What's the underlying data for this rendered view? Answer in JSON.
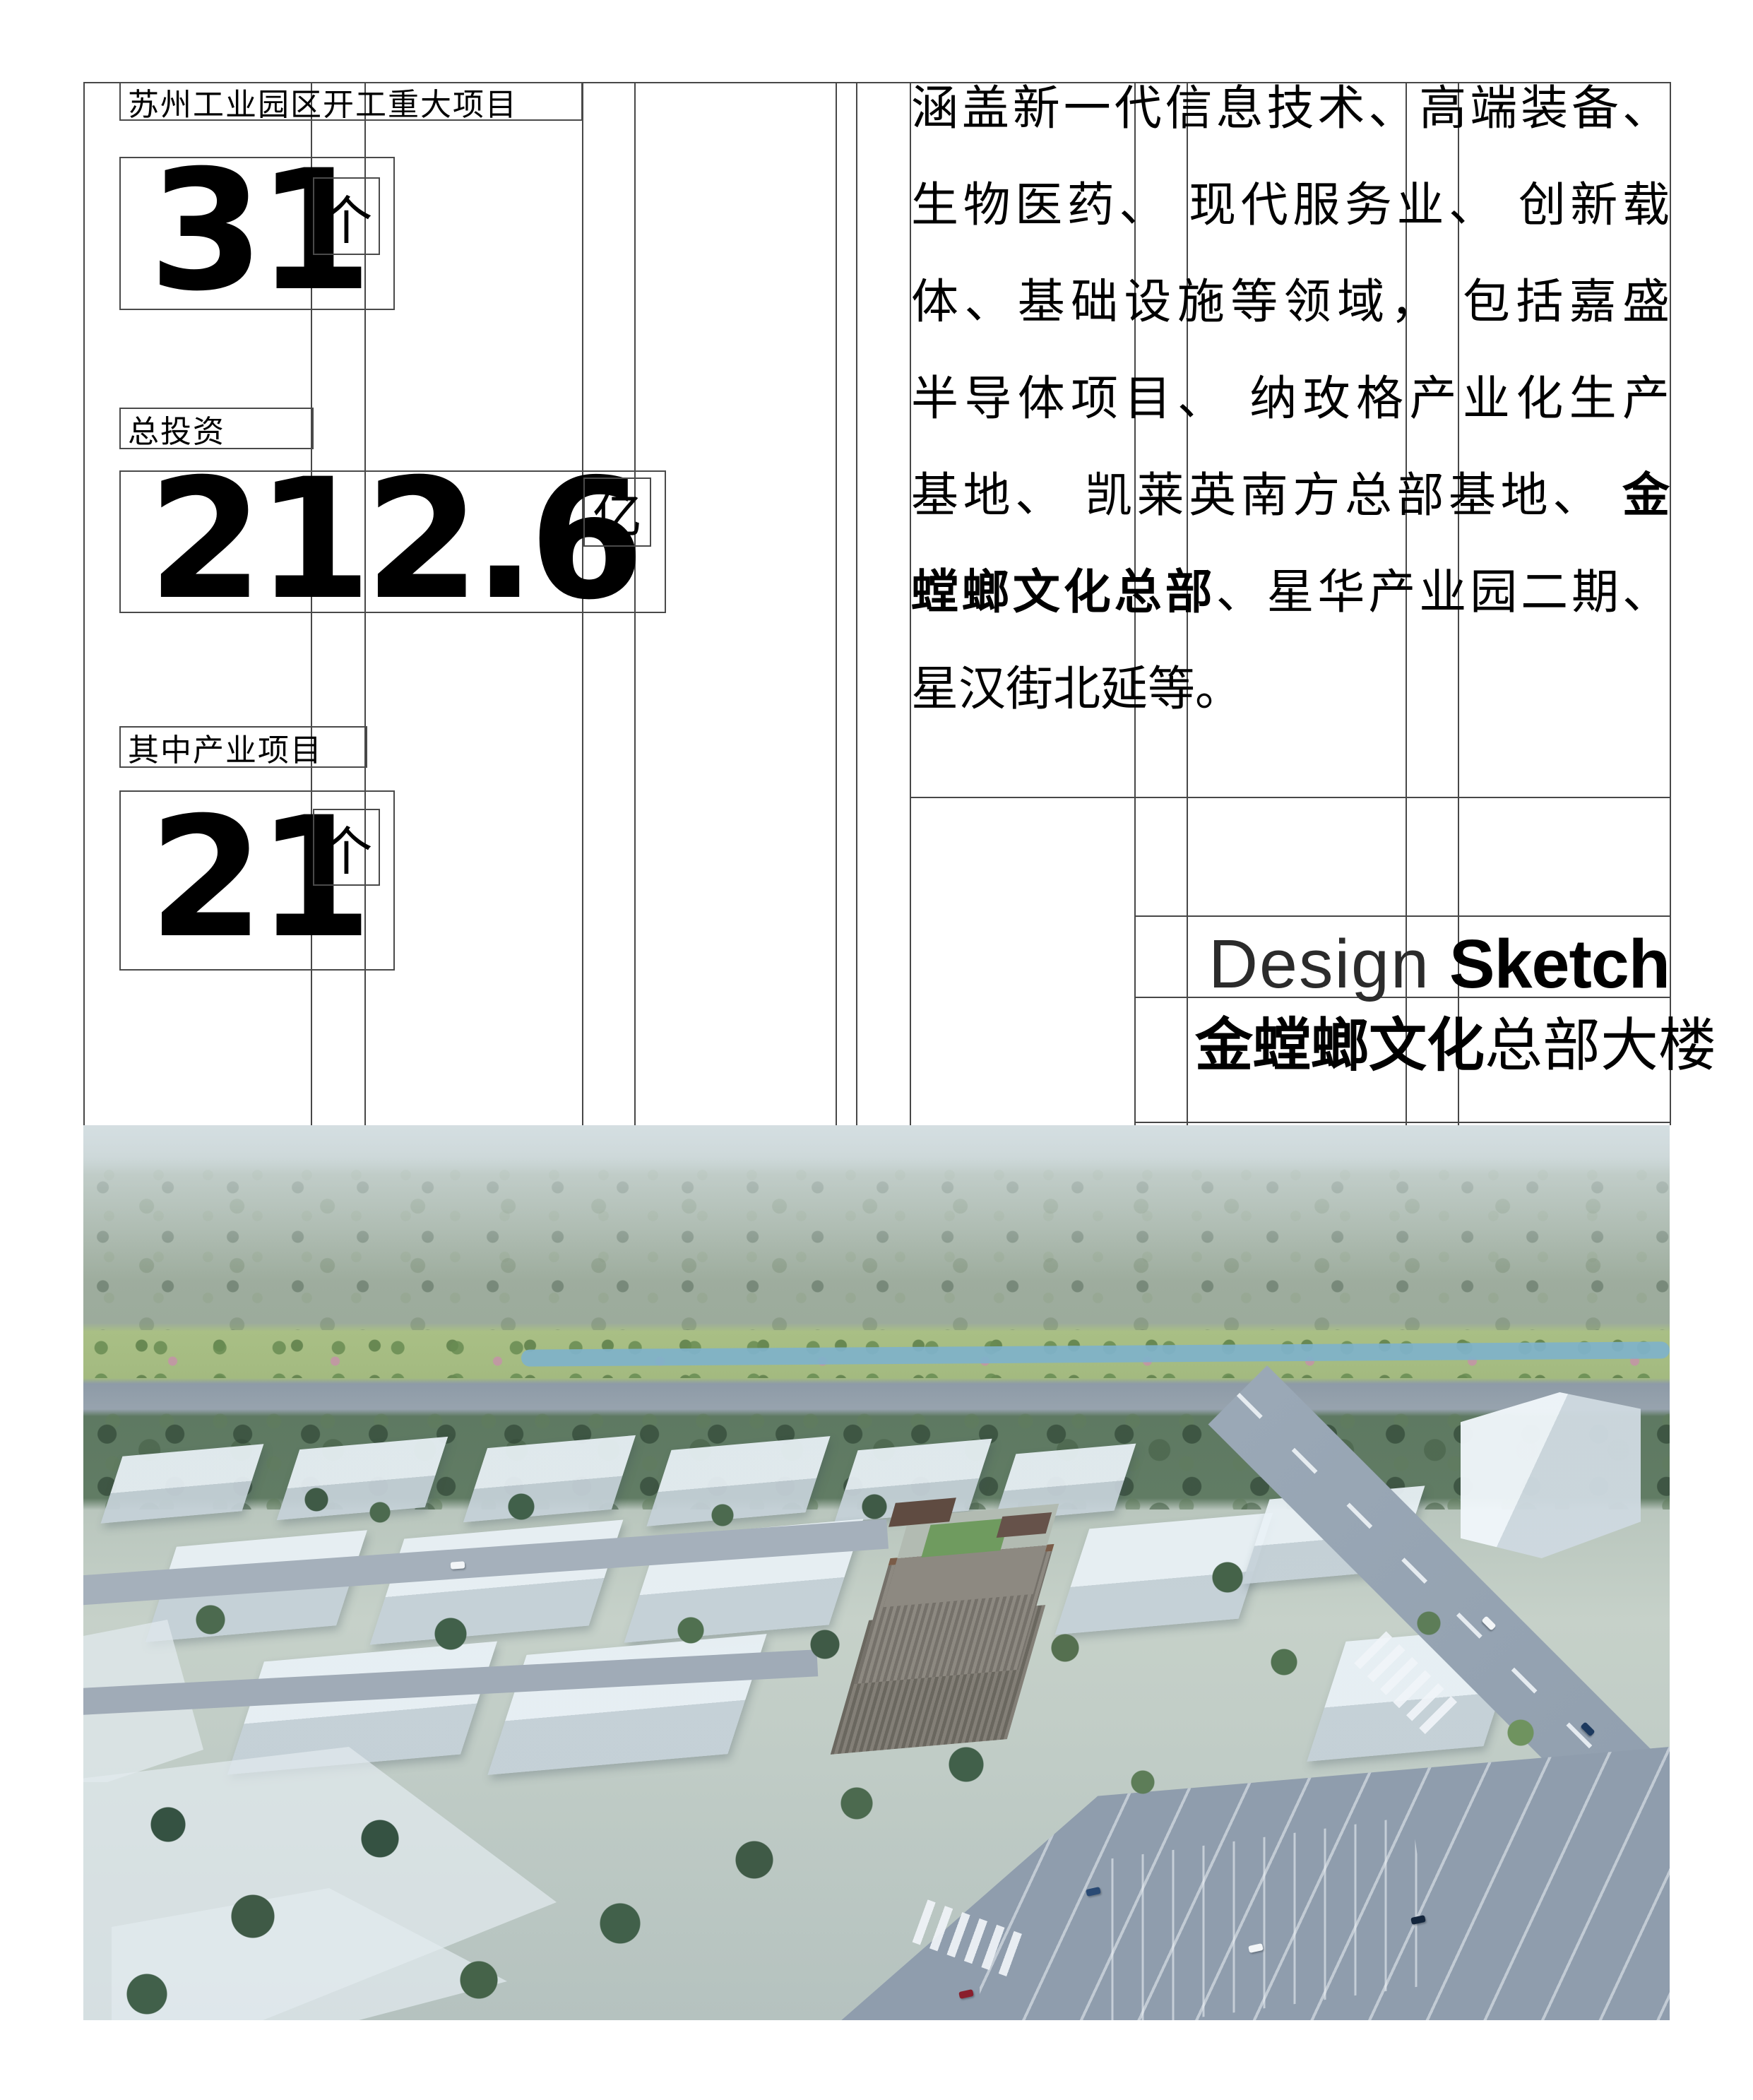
{
  "stats": {
    "header": "苏州工业园区开工重大项目",
    "items": [
      {
        "label": "",
        "value": "31",
        "unit": "个"
      },
      {
        "label": "总投资",
        "value": "212.6",
        "unit": "亿"
      },
      {
        "label": "其中产业项目",
        "value": "21",
        "unit": "个"
      }
    ]
  },
  "description": {
    "lines": [
      {
        "n1": "涵盖新一代信息技术、高端装备、",
        "b": "",
        "n2": ""
      },
      {
        "n1": "生物医药、 现代服务业、 创新载",
        "b": "",
        "n2": ""
      },
      {
        "n1": "体、基础设施等领域， 包括嘉盛",
        "b": "",
        "n2": ""
      },
      {
        "n1": "半导体项目、 纳玫格产业化生产",
        "b": "",
        "n2": ""
      },
      {
        "n1": "基地、 凯莱英南方总部基地、 ",
        "b": "金",
        "n2": ""
      },
      {
        "n1": "",
        "b": "螳螂文化总部",
        "n2": "、星华产业园二期、"
      },
      {
        "n1": "星汉街北延等。",
        "b": "",
        "n2": ""
      }
    ]
  },
  "design_sketch": {
    "word_light": "Design",
    "word_bold": "Sketch",
    "caption_bold": "金螳螂文化",
    "caption_regular": "总部大楼"
  },
  "colors": {
    "guide_line": "#474747",
    "text": "#000000",
    "photo_sky": "#c8d3d7",
    "photo_forest": "#5e7962",
    "photo_road": "#9aa8b6",
    "massing_block": "#e9f1f6",
    "hq_bronze": "#7a5c48"
  }
}
